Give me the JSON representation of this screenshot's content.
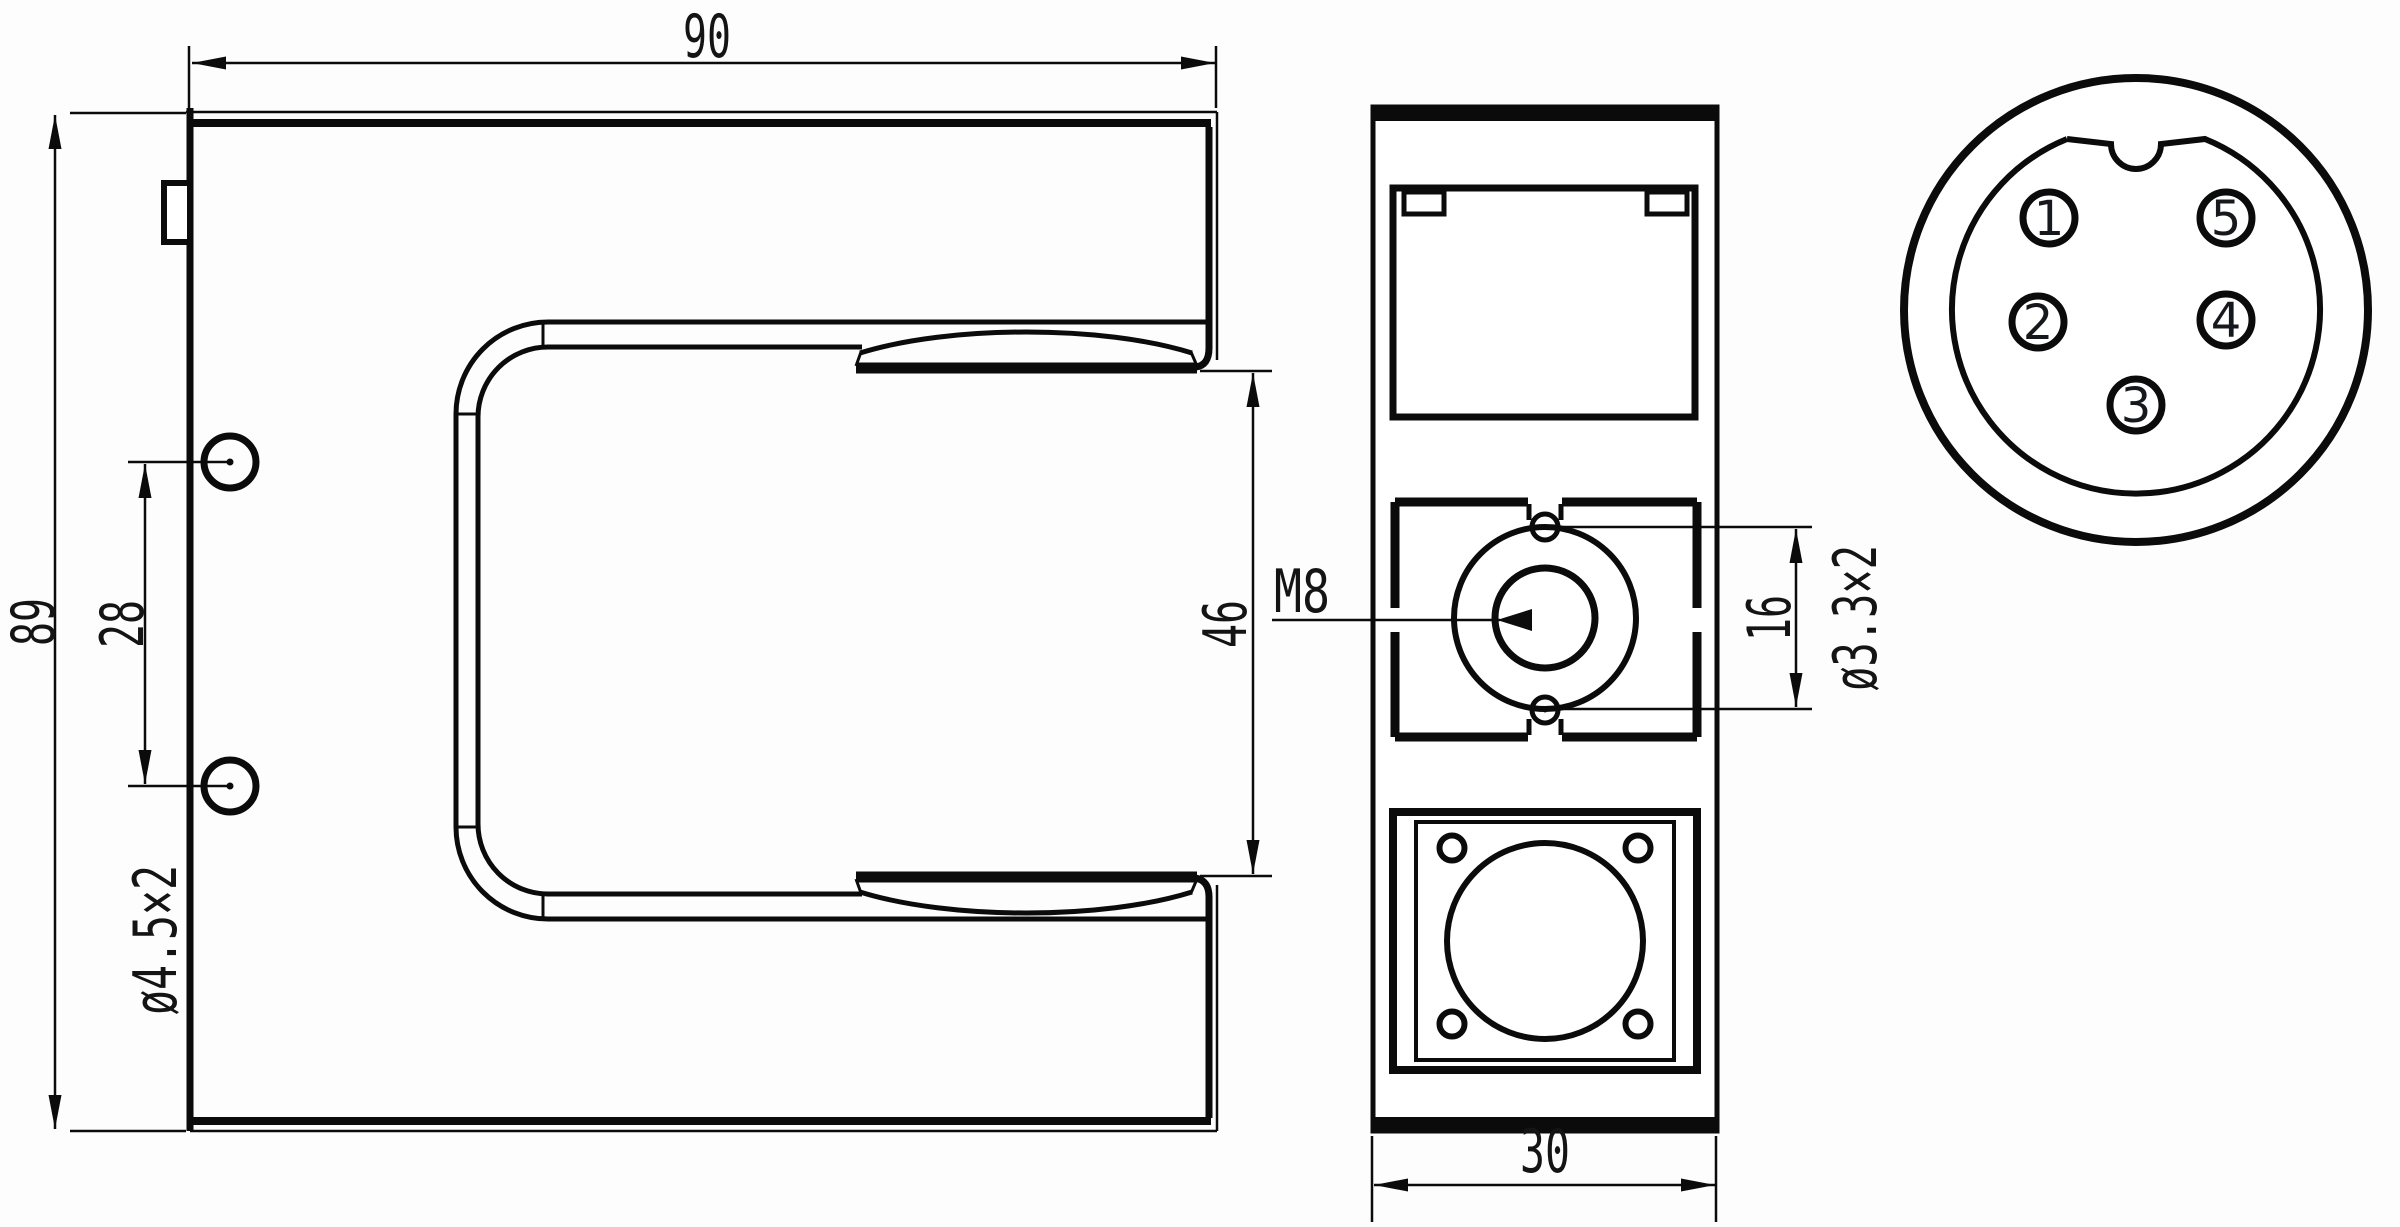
{
  "colors": {
    "ink": "#0b0b0b",
    "paper": "#ffffff"
  },
  "front_view": {
    "width_label": "90",
    "height_label": "89",
    "hole_spacing_label": "28",
    "hole_callout": "ø4.5×2",
    "slot_height_label": "46"
  },
  "side_view": {
    "thread_callout": "M8",
    "hole_pitch_label": "16",
    "hole_callout": "ø3.3×2",
    "width_label": "30"
  },
  "connector_view": {
    "pin_labels": [
      "1",
      "2",
      "3",
      "4",
      "5"
    ]
  }
}
